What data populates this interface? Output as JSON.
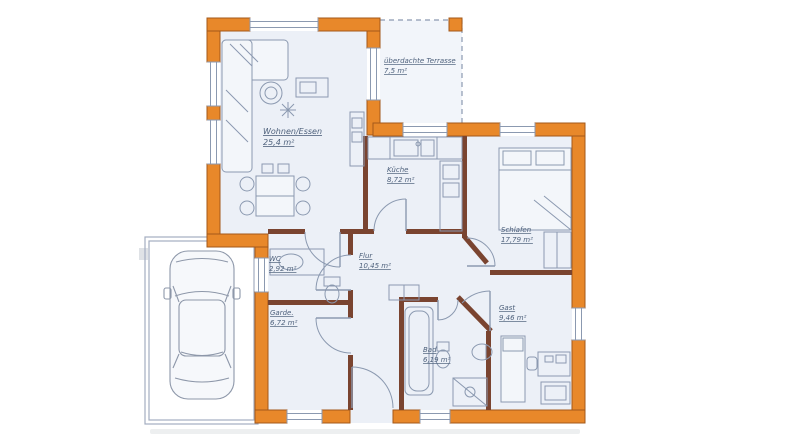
{
  "plan": {
    "rooms": [
      {
        "id": "terrasse",
        "name": "überdachte Terrasse",
        "area": "7,5 m²"
      },
      {
        "id": "wohnen-essen",
        "name": "Wohnen/Essen",
        "area": "25,4 m²"
      },
      {
        "id": "kueche",
        "name": "Küche",
        "area": "8,72 m²"
      },
      {
        "id": "schlafen",
        "name": "Schlafen",
        "area": "17,79 m²"
      },
      {
        "id": "wc",
        "name": "WC",
        "area": "2,92 m²"
      },
      {
        "id": "flur",
        "name": "Flur",
        "area": "10,45 m²"
      },
      {
        "id": "garderobe",
        "name": "Garde.",
        "area": "6,72 m²"
      },
      {
        "id": "bad",
        "name": "Bad",
        "area": "6,19 m²"
      },
      {
        "id": "gast",
        "name": "Gast",
        "area": "9,46 m²"
      }
    ],
    "colors": {
      "wall": "#e8882a",
      "wallStroke": "#a3581a",
      "innerWall": "#7a4430",
      "floor": "#ecf0f7",
      "terrace": "#f2f5fa",
      "line": "#8b99b0",
      "label": "#4e617c",
      "hatch": "#a3adc0",
      "car": "#8d97a9"
    }
  }
}
